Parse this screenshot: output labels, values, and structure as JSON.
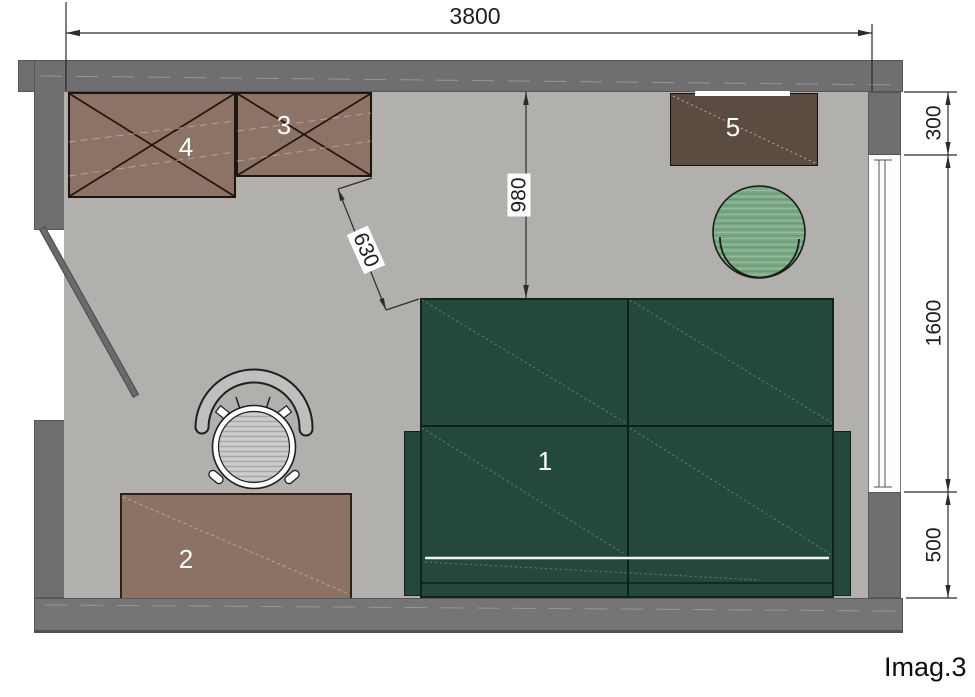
{
  "caption": "Imag.3",
  "dimensions": {
    "total_width": "3800",
    "right_wall_top_segment": "300",
    "window_height": "1600",
    "right_wall_bottom_segment": "500",
    "wall_to_bed_clearance": "980",
    "wardrobe_to_bed_clearance": "630"
  },
  "furniture": {
    "bed": {
      "label": "1"
    },
    "desk": {
      "label": "2"
    },
    "wardrobe_small": {
      "label": "3"
    },
    "wardrobe_large": {
      "label": "4"
    },
    "sideboard": {
      "label": "5"
    }
  },
  "colors": {
    "wall": "#6f6f72",
    "floor": "#b2b0ac",
    "bed_green": "#24493b",
    "wardrobe_brown": "#8d7365",
    "sideboard_dark_brown": "#5c4b41",
    "desk_brown": "#8b7263",
    "chair_green": "#7dab86",
    "chair_gray": "#c6c6c4",
    "dimension_text": "#1d1d1d",
    "label_text": "#ffffff"
  }
}
